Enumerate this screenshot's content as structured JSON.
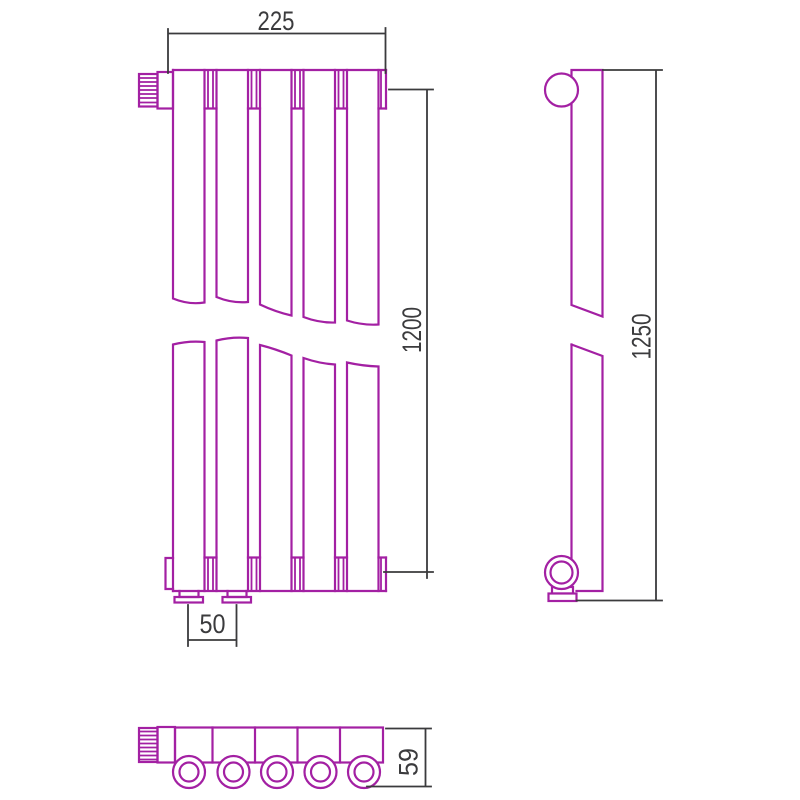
{
  "drawing": {
    "title": "Radiator technical drawing, three views",
    "colors": {
      "outline": "#A320A3",
      "dimension": "#3B3B3D",
      "background": "#FFFFFF"
    },
    "views": {
      "front": {
        "label": "front view",
        "sections": 5,
        "has_break": true
      },
      "side": {
        "label": "side view",
        "has_break": true
      },
      "bottom": {
        "label": "bottom view",
        "sections": 5,
        "collector_rings": 5
      }
    },
    "dimensions": {
      "width": "225",
      "axis_height": "1200",
      "connection_spacing": "50",
      "total_height": "1250",
      "depth": "59"
    }
  }
}
